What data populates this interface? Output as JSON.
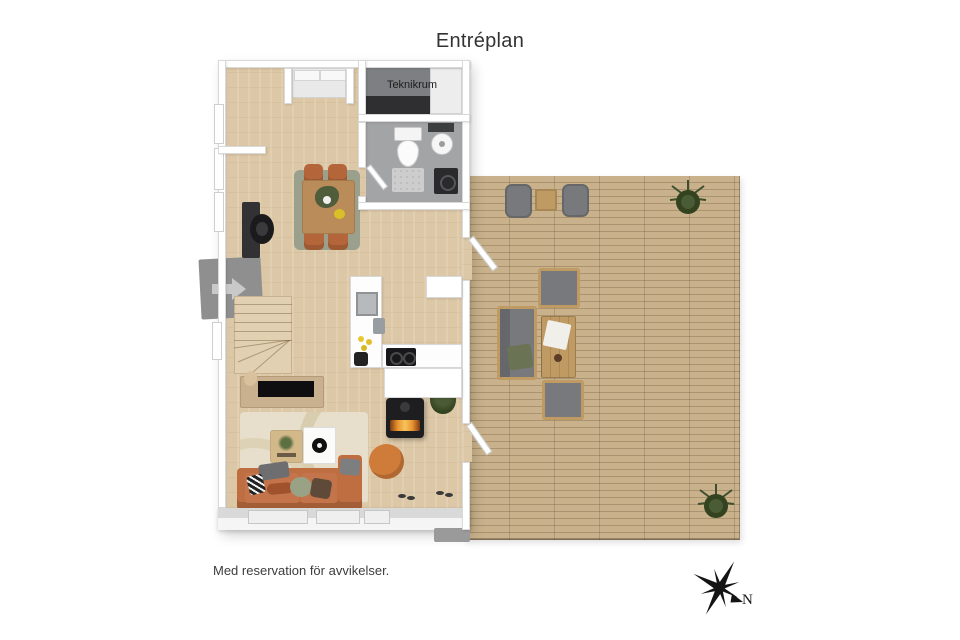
{
  "title": "Entréplan",
  "labels": {
    "teknikrum": "Teknikrum"
  },
  "disclaimer": "Med reservation för avvikelser.",
  "compass": {
    "north_label": "N"
  },
  "colors": {
    "wall": "#ffffff",
    "wall_edge": "#d9d9d9",
    "floor_wood": "#dcc7a6",
    "deck_wood": "#c9b28b",
    "deck_line": "#ab9370",
    "teknik_floor": "#7e7f82",
    "teknik_dark": "#2f2f31",
    "bath_floor": "#a3a4a6",
    "rug_living": "#e7dfcc",
    "rug_dining": "#9aa08c",
    "sofa_terracotta": "#bf6e41",
    "pouf_orange": "#cf7b3a",
    "chair_terracotta": "#b4663a",
    "table_wood": "#b98c59",
    "bench_wood": "#c9b190",
    "outdoor_wood": "#c09a63",
    "outdoor_cushion": "#77797c",
    "stove_black": "#1e1e20",
    "fire_glow": "#e8922f",
    "plant_green": "#3d4f2c"
  }
}
